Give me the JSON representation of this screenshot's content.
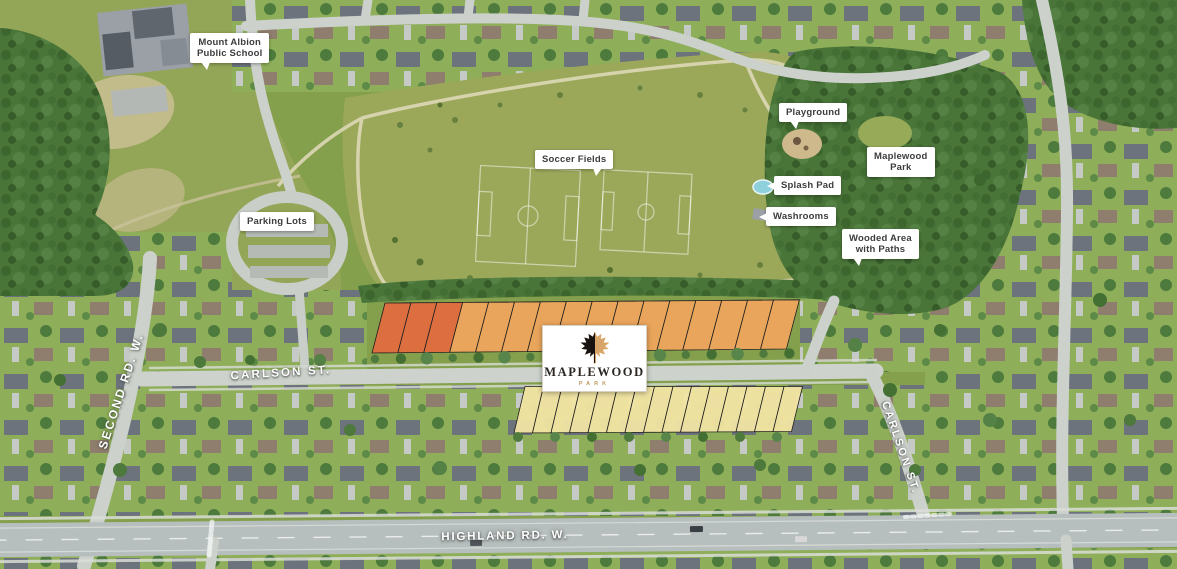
{
  "callouts": {
    "school": {
      "line1": "Mount Albion",
      "line2": "Public School"
    },
    "parking": {
      "line1": "Parking Lots"
    },
    "soccer": {
      "line1": "Soccer Fields"
    },
    "playground": {
      "line1": "Playground"
    },
    "splash": {
      "line1": "Splash Pad"
    },
    "washrooms": {
      "line1": "Washrooms"
    },
    "park_name": {
      "line1": "Maplewood",
      "line2": "Park"
    },
    "wooded": {
      "line1": "Wooded Area",
      "line2": "with Paths"
    }
  },
  "streets": {
    "carlson": "CARLSON ST.",
    "second": "SECOND RD. W.",
    "highland": "HIGHLAND RD. W.",
    "carlson_vertical": "CARLSON ST."
  },
  "logo": {
    "name": "MAPLEWOOD",
    "subtitle": "PARK"
  },
  "lots": {
    "north": {
      "count": 16,
      "red_count": 3,
      "colors": {
        "red": "#e4693f",
        "orange": "#f2a55c"
      }
    },
    "south": {
      "count": 15,
      "color": "#f2e4a4"
    }
  },
  "colors": {
    "leaf_black": "#171310",
    "leaf_gold": "#d7a668",
    "park_grass": "#9ba85a",
    "woods_green": "#4a7539",
    "road_gray": "#ccd1cc",
    "highway_gray": "#b7bebe"
  }
}
